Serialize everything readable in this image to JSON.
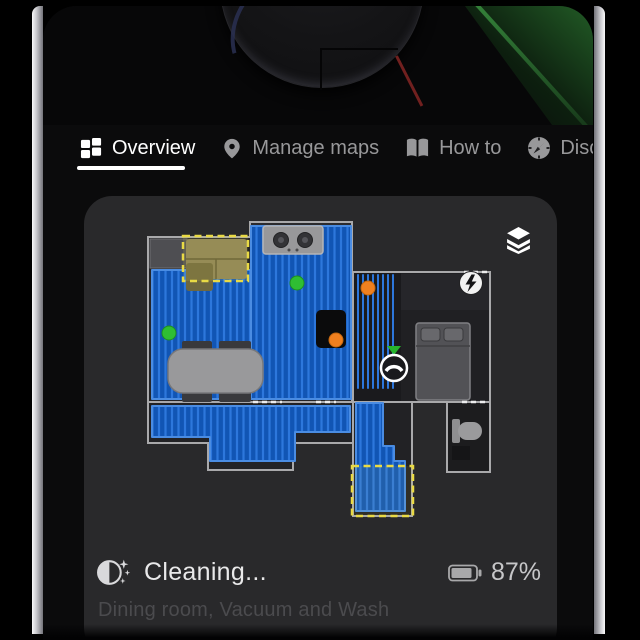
{
  "tabs": {
    "items": [
      {
        "label": "Overview",
        "icon": "grid-icon",
        "active": true
      },
      {
        "label": "Manage maps",
        "icon": "map-pin-icon",
        "active": false
      },
      {
        "label": "How to",
        "icon": "open-book-icon",
        "active": false
      },
      {
        "label": "Discover",
        "icon": "compass-icon",
        "active": false
      }
    ]
  },
  "map": {
    "layers_button_icon": "layers-icon",
    "charger": {
      "cx": "471",
      "cy": "283"
    },
    "robot": {
      "cx": "394",
      "cy": "368"
    },
    "robot_direction_marker": "394,355 387,346 401,346",
    "zones": [
      {
        "x": "183",
        "y": "236",
        "w": "65",
        "h": "45"
      },
      {
        "x": "352",
        "y": "466",
        "w": "61",
        "h": "50"
      }
    ],
    "dots": [
      {
        "cx": "169",
        "cy": "333",
        "fill": "#2fbe33"
      },
      {
        "cx": "297",
        "cy": "283",
        "fill": "#2fbe33"
      },
      {
        "cx": "368",
        "cy": "288",
        "fill": "#f0801f"
      },
      {
        "cx": "336",
        "cy": "340",
        "fill": "#f0801f"
      }
    ],
    "colors": {
      "cleaned_blue": "#1155b4",
      "cleaned_blue_stripe": "#2d77dc",
      "zone_yellow": "#e9da45",
      "wall_gray": "#a9a9ab",
      "dot_green": "#2fbe33",
      "dot_orange": "#f0801f"
    }
  },
  "status": {
    "icon": "cleaning-progress-icon",
    "title": "Cleaning...",
    "subtitle": "Dining room, Vacuum and Wash",
    "battery_icon": "battery-icon",
    "battery": "87%"
  }
}
